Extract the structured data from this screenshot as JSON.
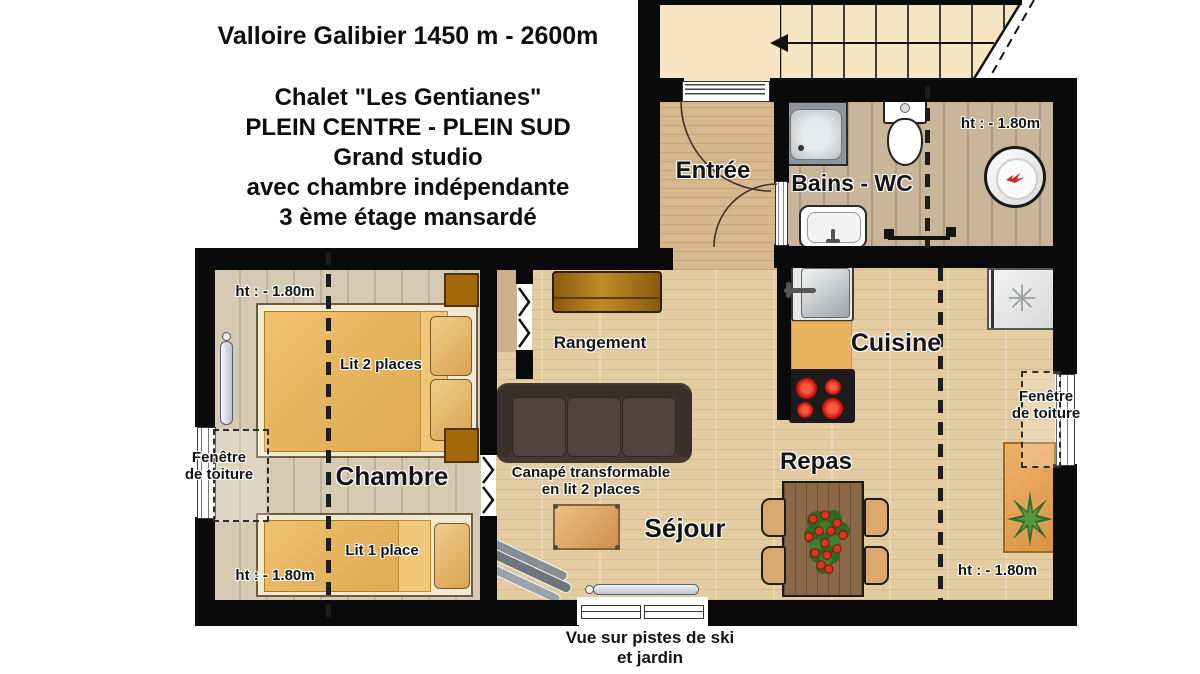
{
  "header": {
    "line1": "Valloire Galibier 1450 m - 2600m",
    "line2": "Chalet \"Les Gentianes\"",
    "line3": "PLEIN CENTRE - PLEIN SUD",
    "line4": "Grand studio",
    "line5": "avec chambre indépendante",
    "line6": "3 ème étage  mansardé"
  },
  "rooms": {
    "entree": "Entrée",
    "bains_wc": "Bains - WC",
    "cuisine": "Cuisine",
    "chambre": "Chambre",
    "sejour": "Séjour",
    "repas": "Repas",
    "rangement": "Rangement"
  },
  "furniture": {
    "double_bed": "Lit 2 places",
    "single_bed": "Lit 1 place",
    "sofa_line1": "Canapé transformable",
    "sofa_line2": "en lit 2 places"
  },
  "height_notes": {
    "bains": "ht : - 1.80m",
    "chambre_top": "ht : - 1.80m",
    "chambre_bottom": "ht : - 1.80m",
    "sejour": "ht : - 1.80m"
  },
  "windows": {
    "roof_window_line1": "Fenêtre",
    "roof_window_line2": "de toiture",
    "view_line1": "Vue sur pistes de ski",
    "view_line2": "et jardin"
  },
  "icons": {
    "freezer_glyph": "✳"
  },
  "colors": {
    "wall": "#0a0a0a",
    "stairs": "#f6e6c3",
    "floor_entree": "#d7b78d",
    "floor_bains": "#c8b59a",
    "floor_chambre": "#d6cab4",
    "floor_sejour": "#e3cca2",
    "mattress": "#e9b562",
    "counter": "#eab45e",
    "sofa": "#463931",
    "stove_burner": "#cc1111",
    "dining_table": "#8a6848"
  }
}
